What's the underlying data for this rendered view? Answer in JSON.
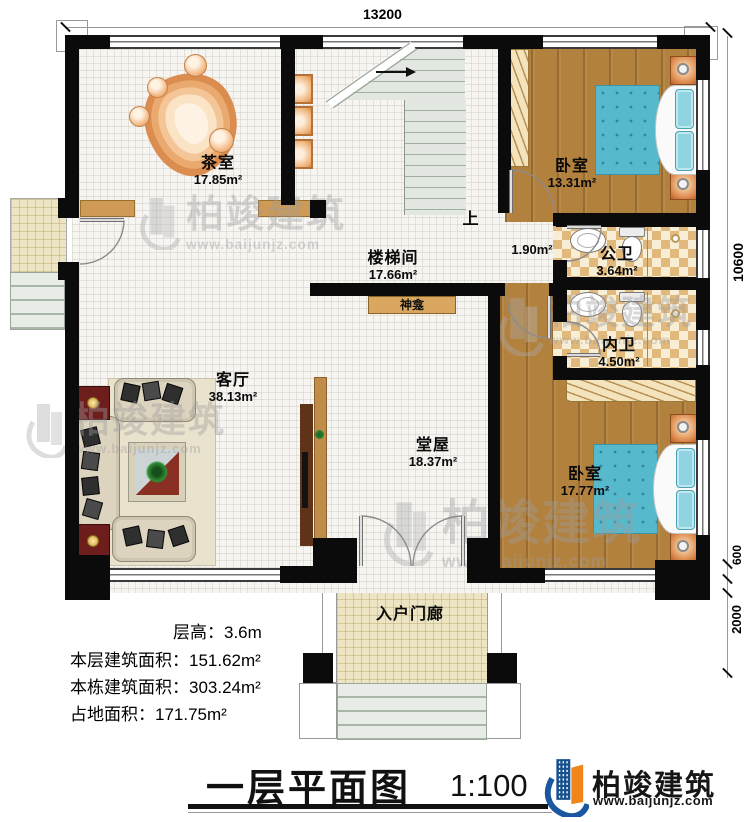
{
  "title": {
    "text": "一层平面图",
    "scale": "1:100"
  },
  "dims": {
    "top": "13200",
    "right": "10600",
    "porch_a": "600",
    "porch_b": "2000"
  },
  "rooms": [
    {
      "name": "茶室",
      "area": "17.85m²"
    },
    {
      "name": "楼梯间",
      "area": "17.66m²"
    },
    {
      "name": "卧室",
      "area": "13.31m²"
    },
    {
      "name": "公卫",
      "area": "3.64m²"
    },
    {
      "name": "内卫",
      "area": "4.50m²"
    },
    {
      "name": "卧室",
      "area": "17.77m²"
    },
    {
      "name": "客厅",
      "area": "38.13m²"
    },
    {
      "name": "堂屋",
      "area": "18.37m²"
    },
    {
      "name": "入户门廊",
      "area": ""
    },
    {
      "name": "",
      "area": "1.90m²"
    }
  ],
  "annotations": {
    "shrine": "神龛",
    "up": "上"
  },
  "info": [
    "层高：3.6m",
    "本层建筑面积：151.62m²",
    "本栋建筑面积：303.24m²",
    "占地面积：171.75m²"
  ],
  "brand": {
    "name": "柏竣建筑",
    "url": "www.baijunjz.com"
  },
  "watermark": {
    "name": "柏竣建筑",
    "url": "www.baijunjz.com"
  },
  "colors": {
    "wall": "#0b0b0b",
    "wood_floor": "#b2813e",
    "tile": "#e2b97c",
    "bed": "#57b9cc",
    "brand_blue": "#1b57a0",
    "brand_orange": "#f08519"
  }
}
